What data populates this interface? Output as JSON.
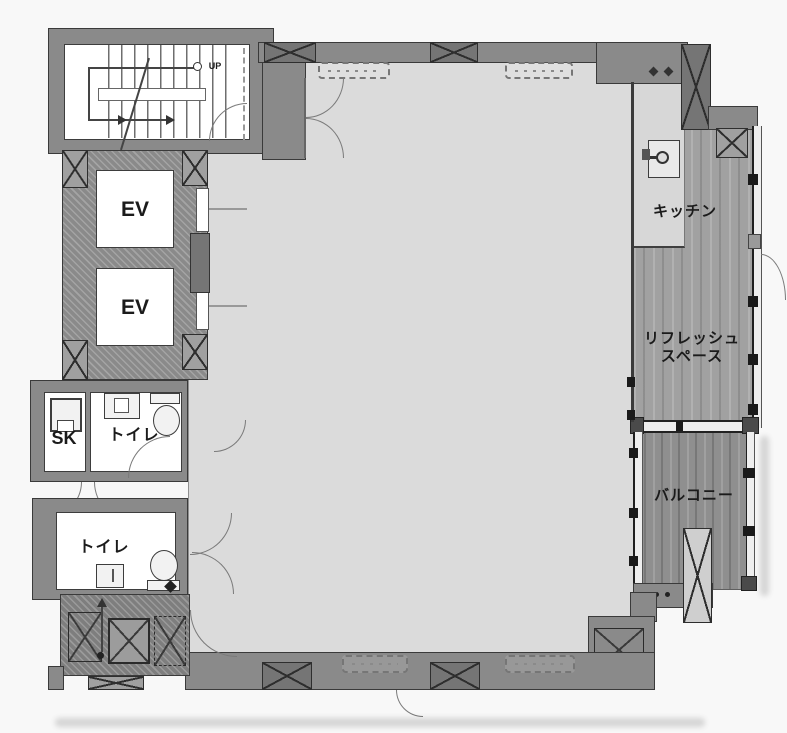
{
  "labels": {
    "up": "UP",
    "ev_top": "EV",
    "ev_bottom": "EV",
    "sk": "SK",
    "toilet_upper": "トイレ",
    "toilet_lower": "トイレ",
    "kitchen": "キッチン",
    "refresh_line1": "リフレッシュ",
    "refresh_line2": "スペース",
    "balcony": "バルコニー"
  },
  "colors": {
    "background": "#f8f8f8",
    "floor": "#dbdbdb",
    "wall_fill": "#8a8a8a",
    "wall_line": "#3a3a3a",
    "room_fill": "#ffffff",
    "wood_refresh": "#a1a1a1",
    "wood_balcony": "#8f8f8f",
    "column_fill": "#757575",
    "label_text": "#1b1b1b",
    "arc_line": "#7a7a7a"
  }
}
